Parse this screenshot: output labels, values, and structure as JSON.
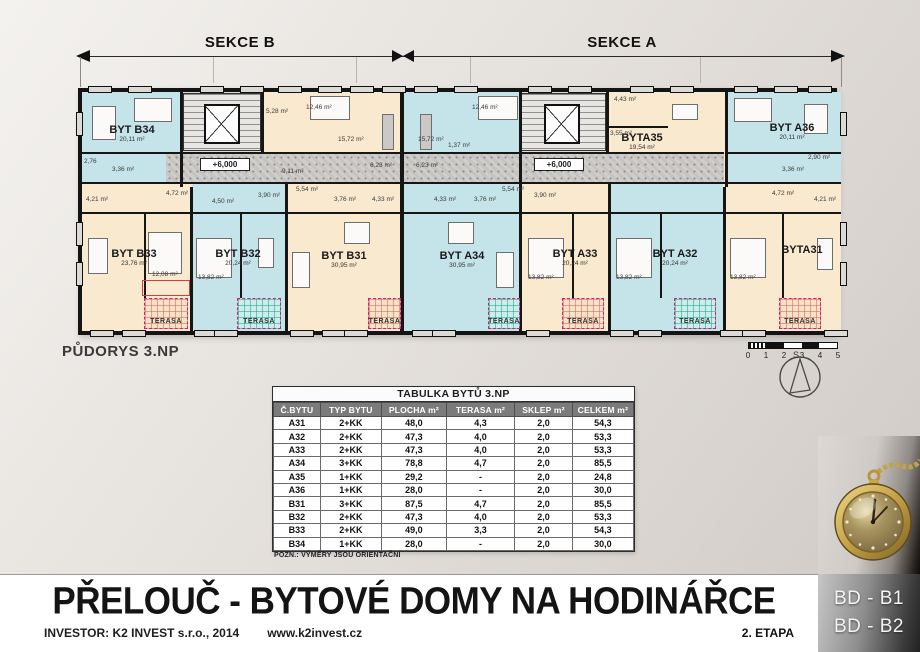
{
  "sections": {
    "left": "SEKCE B",
    "right": "SEKCE A"
  },
  "plan": {
    "caption": "PŮDORYS 3.NP",
    "level": "+6,000",
    "terasa": "TERASA",
    "compass": "S",
    "scale": [
      "0",
      "1",
      "2",
      "3",
      "4",
      "5"
    ],
    "apartments": {
      "b34": {
        "name": "BYT B34",
        "area": "20,11 m²"
      },
      "b33": {
        "name": "BYT B33",
        "area": "23,76 m²"
      },
      "b32": {
        "name": "BYT B32",
        "area": "20,24 m²"
      },
      "b31": {
        "name": "BYT B31",
        "area": "30,95 m²"
      },
      "a34": {
        "name": "BYT A34",
        "area": "30,95 m²"
      },
      "a33": {
        "name": "BYT A33",
        "area": "20,24 m²"
      },
      "a32": {
        "name": "BYT A32",
        "area": "20,24 m²"
      },
      "a31": {
        "name": "BYTA31"
      },
      "a35": {
        "name": "BYTA35",
        "area": "19,54 m²"
      },
      "a36": {
        "name": "BYT A36",
        "area": "20,11 m²"
      }
    },
    "rooms": {
      "r276": "2,76",
      "r336": "3,36 m²",
      "r290": "2,90 m²",
      "r528": "5,28 m²",
      "r1246": "12,46 m²",
      "r1572": "15,72 m²",
      "r911": "9,11 m²",
      "r443": "4,43 m²",
      "r355": "3,55 m²",
      "r421": "4,21 m²",
      "r472": "4,72 m²",
      "r450": "4,50 m²",
      "r554": "5,54 m²",
      "r376": "3,76 m²",
      "r390": "3,90 m²",
      "r137": "1,37 m²",
      "r623": "6,23 m²",
      "r433": "4,33 m²",
      "r1208": "12,08 m²",
      "r1382": "13,82 m²"
    }
  },
  "table": {
    "title": "TABULKA BYTŮ 3.NP",
    "columns": [
      "Č.BYTU",
      "TYP BYTU",
      "PLOCHA m²",
      "TERASA m²",
      "SKLEP m²",
      "CELKEM m²"
    ],
    "rows": [
      [
        "A31",
        "2+KK",
        "48,0",
        "4,3",
        "2,0",
        "54,3"
      ],
      [
        "A32",
        "2+KK",
        "47,3",
        "4,0",
        "2,0",
        "53,3"
      ],
      [
        "A33",
        "2+KK",
        "47,3",
        "4,0",
        "2,0",
        "53,3"
      ],
      [
        "A34",
        "3+KK",
        "78,8",
        "4,7",
        "2,0",
        "85,5"
      ],
      [
        "A35",
        "1+KK",
        "29,2",
        "-",
        "2,0",
        "24,8"
      ],
      [
        "A36",
        "1+KK",
        "28,0",
        "-",
        "2,0",
        "30,0"
      ],
      [
        "B31",
        "3+KK",
        "87,5",
        "4,7",
        "2,0",
        "85,5"
      ],
      [
        "B32",
        "2+KK",
        "47,3",
        "4,0",
        "2,0",
        "53,3"
      ],
      [
        "B33",
        "2+KK",
        "49,0",
        "3,3",
        "2,0",
        "54,3"
      ],
      [
        "B34",
        "1+KK",
        "28,0",
        "-",
        "2,0",
        "30,0"
      ]
    ],
    "note": "POZN.: VÝMĚRY JSOU ORIENTAČNÍ"
  },
  "footer": {
    "title": "PŘELOUČ - BYTOVÉ DOMY NA HODINÁŘCE",
    "investor": "INVESTOR: K2 INVEST s.r.o., 2014",
    "website": "www.k2invest.cz",
    "stage": "2. ETAPA",
    "buildings": [
      "BD - B1",
      "BD - B2"
    ]
  },
  "colors": {
    "apartment_blue": "#c5e4e9",
    "apartment_cream": "#f8e9cf",
    "wall": "#161616",
    "terrace_grid_pink": "#cc2277",
    "header_gray": "#7b7b7b"
  }
}
